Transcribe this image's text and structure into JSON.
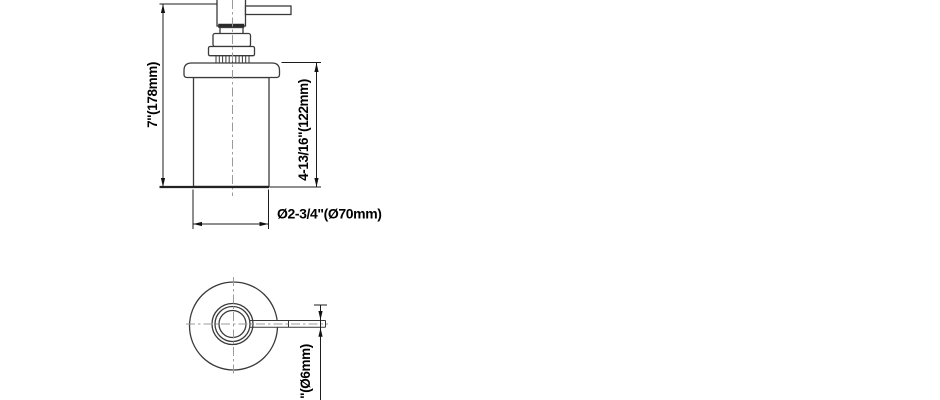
{
  "drawing": {
    "dimensions": {
      "overall_height": "7\"(178mm)",
      "body_height": "4-13/16\"(122mm)",
      "body_diameter": "Ø2-3/4\"(Ø70mm)",
      "spout_diameter_visible": "\"(Ø6mm)"
    },
    "colors": {
      "background": "#ffffff",
      "outline": "#3a3a3a",
      "dimension_line": "#1c1c1c",
      "centerline": "#9b9b9b",
      "label_text": "#000000"
    }
  }
}
